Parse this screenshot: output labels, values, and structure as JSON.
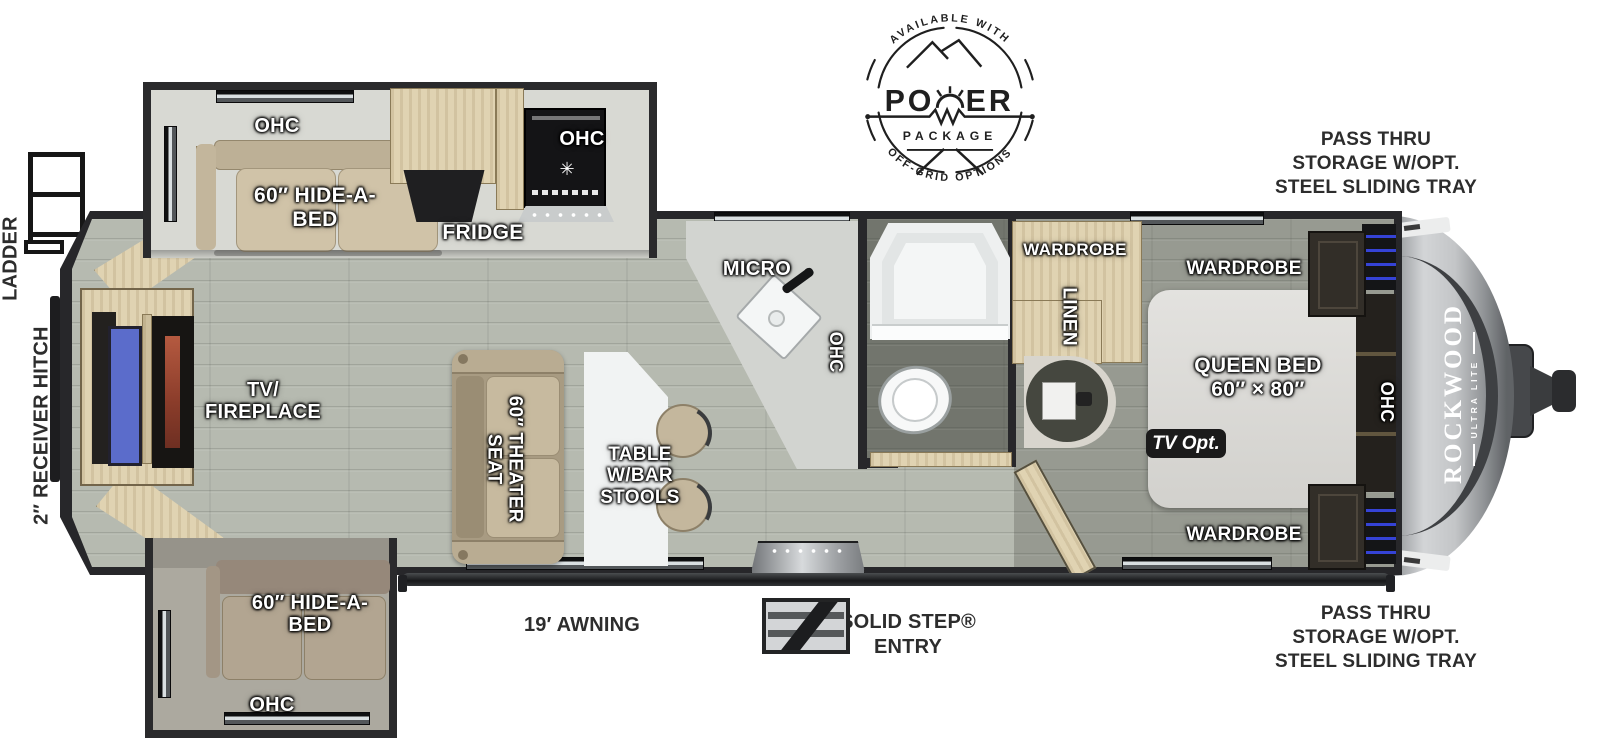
{
  "title": "Rockwood Ultra Lite Travel Trailer Floorplan",
  "badge": {
    "available_with": "AVAILABLE WITH",
    "power_left": "PO",
    "power_right": "ER",
    "package": "PACKAGE",
    "off_grid": "OFF-GRID OPTIONS"
  },
  "branding": {
    "model": "ROCKWOOD",
    "trim": "ULTRA LITE"
  },
  "exterior": {
    "pass_thru_top": [
      "PASS THRU",
      "STORAGE W/OPT.",
      "STEEL SLIDING TRAY"
    ],
    "pass_thru_bottom": [
      "PASS THRU",
      "STORAGE W/OPT.",
      "STEEL SLIDING TRAY"
    ],
    "ladder": "LADDER",
    "receiver_hitch": "2″ RECEIVER HITCH",
    "awning": "19′ AWNING",
    "entry_line1": "SOLID STEP®",
    "entry_line2": "ENTRY"
  },
  "rooms": {
    "slide_top": {
      "ohc": "OHC",
      "hide_a_bed": "60″ HIDE-A-BED"
    },
    "kitchen": {
      "fridge": "FRIDGE",
      "ohc_range": "OHC",
      "micro": "MICRO",
      "ohc_counter": "OHC"
    },
    "bath": {
      "wardrobe": "WARDROBE",
      "linen": "LINEN"
    },
    "bedroom": {
      "wardrobe_top": "WARDROBE",
      "wardrobe_bottom": "WARDROBE",
      "bed_line1": "QUEEN BED",
      "bed_line2": "60″ × 80″",
      "ohc": "OHC",
      "tv_opt": "TV Opt."
    },
    "living": {
      "tv_fireplace_line1": "TV/",
      "tv_fireplace_line2": "FIREPLACE",
      "theater_seat": "60″ THEATER SEAT",
      "table": "TABLE W/BAR STOOLS"
    },
    "slide_bottom": {
      "hide_a_bed": "60″ HIDE-A-BED",
      "ohc": "OHC"
    }
  },
  "colors": {
    "tv_screen": "#5b6ccb",
    "fireplace_flame": "#a34a33",
    "storage_accent": "#3543d6",
    "wood": "#e0d3b2",
    "ink": "#2d2d2d"
  }
}
